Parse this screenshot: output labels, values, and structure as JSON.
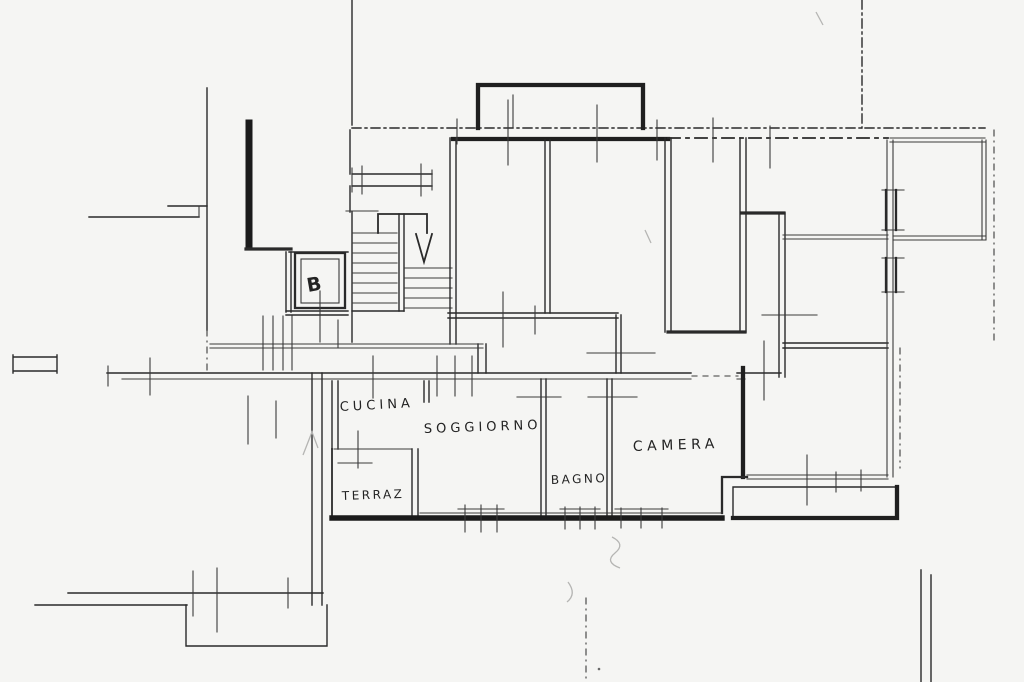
{
  "document": {
    "type": "scanned architectural floor plan",
    "language": "Italian"
  },
  "colors": {
    "paper": "#f5f5f3",
    "ink": "#2a2a2a",
    "ink_heavy": "#1b1b1b",
    "pencil": "#b5b5b3"
  },
  "labels": [
    {
      "id": "cucina",
      "text": "CUCINA",
      "meaning": "kitchen"
    },
    {
      "id": "soggiorno",
      "text": "SOGGIORNO",
      "meaning": "living room"
    },
    {
      "id": "terrazzo",
      "text": "TERRAZ",
      "meaning": "terrace"
    },
    {
      "id": "bagno",
      "text": "BAGNO",
      "meaning": "bathroom"
    },
    {
      "id": "camera",
      "text": "CAMERA",
      "meaning": "bedroom"
    },
    {
      "id": "elevator",
      "text": "B",
      "meaning": "elevator shaft mark"
    }
  ]
}
